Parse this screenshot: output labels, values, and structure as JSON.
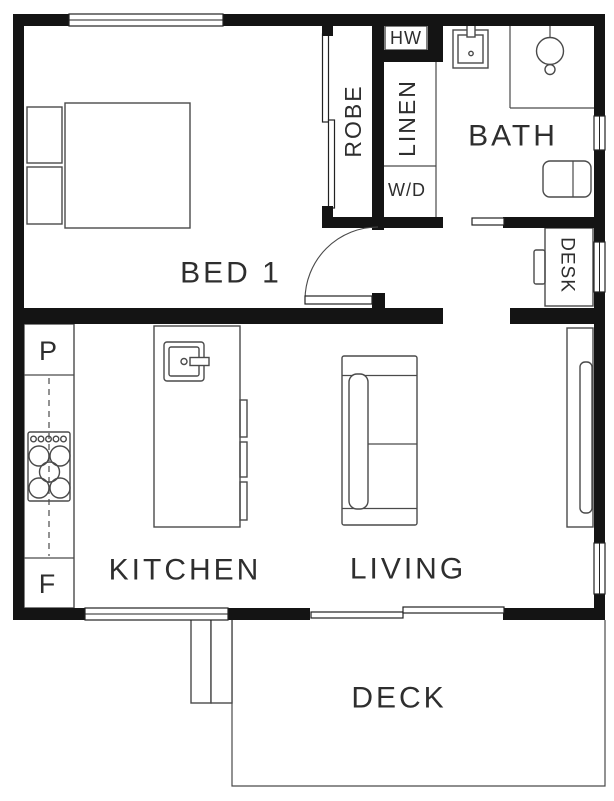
{
  "title": "One-bedroom floor plan",
  "theme": {
    "colors": {
      "wall": "#141414",
      "line": "#4a4a4a",
      "outline": "#222222",
      "ink": "#2e2e2e",
      "bg": "#ffffff"
    }
  },
  "labels": {
    "bed1": "BED 1",
    "bath": "BATH",
    "kitchen": "KITCHEN",
    "living": "LIVING",
    "deck": "DECK",
    "robe": "ROBE",
    "linen": "LINEN",
    "hw": "HW",
    "wd": "W/D",
    "desk": "DESK",
    "pantry": "P",
    "fridge": "F"
  }
}
